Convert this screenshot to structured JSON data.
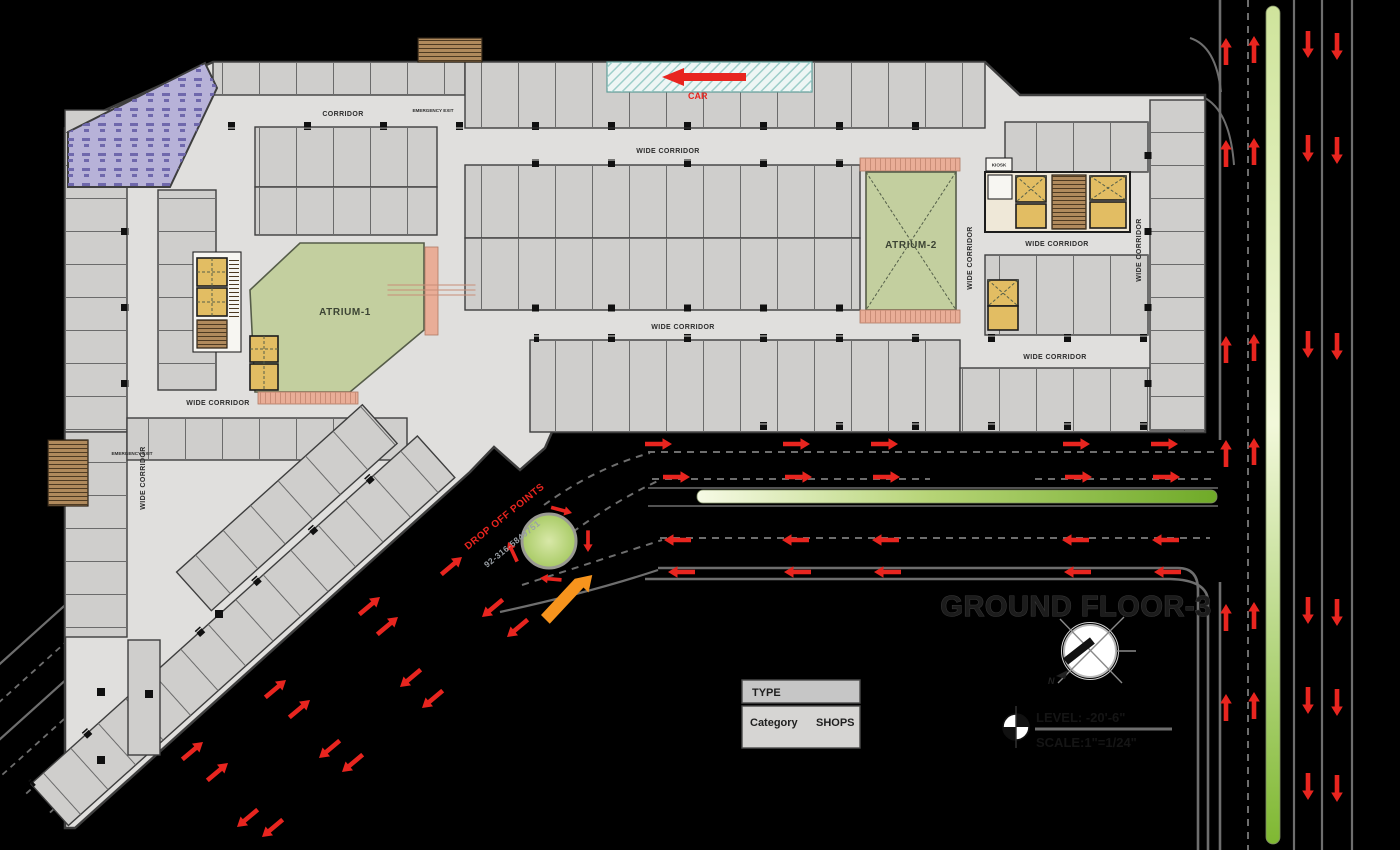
{
  "title": {
    "text": "GROUND FLOOR-3",
    "level": "LEVEL: -20'-6\"",
    "scale": "SCALE:1\"=1/24\"",
    "north_letter": "N"
  },
  "legend": {
    "header": "TYPE",
    "category_label": "Category",
    "category_value": "SHOPS"
  },
  "areas": {
    "atrium1": "ATRIUM-1",
    "atrium2": "ATRIUM-2",
    "kiosk": "KIOSK"
  },
  "labels": {
    "corridor": "CORRIDOR",
    "wide_corridor": "WIDE CORRIDOR",
    "emergency_exit": "EMERGENCY EXIT"
  },
  "annotations": {
    "car": "CAR",
    "drop_off": "DROP OFF POINTS",
    "phone": "92-316-5849751"
  },
  "colors": {
    "bg": "#000000",
    "floor": "#e0dfdd",
    "shop": "#cfcecc",
    "wall": "#3e3e3e",
    "wall2": "#565d49",
    "divider": "#6b6b6b",
    "label": "#2d2d2d",
    "atrium": "#c3cf9f",
    "escalator": "#e9ad97",
    "lift": "#e2bd63",
    "stairs": "#b08a5d",
    "foodcourt": "#b7b2d8",
    "road": "#6e6e6e",
    "grass": "#7fb832",
    "grass_light": "#f6fae5",
    "arrow": "#e8251f",
    "orange": "#f7941d"
  }
}
